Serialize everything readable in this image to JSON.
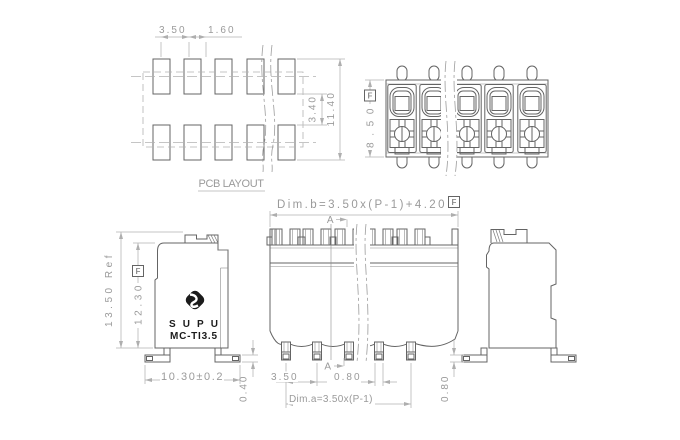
{
  "drawing": {
    "background": "#ffffff",
    "line_color": "#646464",
    "dim_color": "#9a9a9a",
    "logo_color": "#1b1b1b"
  },
  "views": {
    "pcb_layout": {
      "title": "PCB LAYOUT",
      "dim_pitch": "3.50",
      "dim_pad_width": "1.60",
      "dim_row_gap": "3.40",
      "dim_total_height": "11.40"
    },
    "top_view": {
      "dim_height": "8.50",
      "datum": "F"
    },
    "side_view": {
      "brand": "SUPU",
      "model": "MC-TI3.5",
      "dim_overall_height": "13.50 Ref",
      "dim_body_height": "12.30",
      "datum": "F",
      "dim_width": "10.30±0.2",
      "dim_foot_thickness": "0.40"
    },
    "front_view": {
      "dim_b": "Dim.b=3.50x(P-1)+4.20",
      "datum": "F",
      "section_label": "A",
      "dim_pitch": "3.50",
      "dim_pin_width": "0.80",
      "dim_a": "Dim.a=3.50x(P-1)"
    },
    "section_view": {
      "dim_foot_height": "0.80"
    }
  }
}
